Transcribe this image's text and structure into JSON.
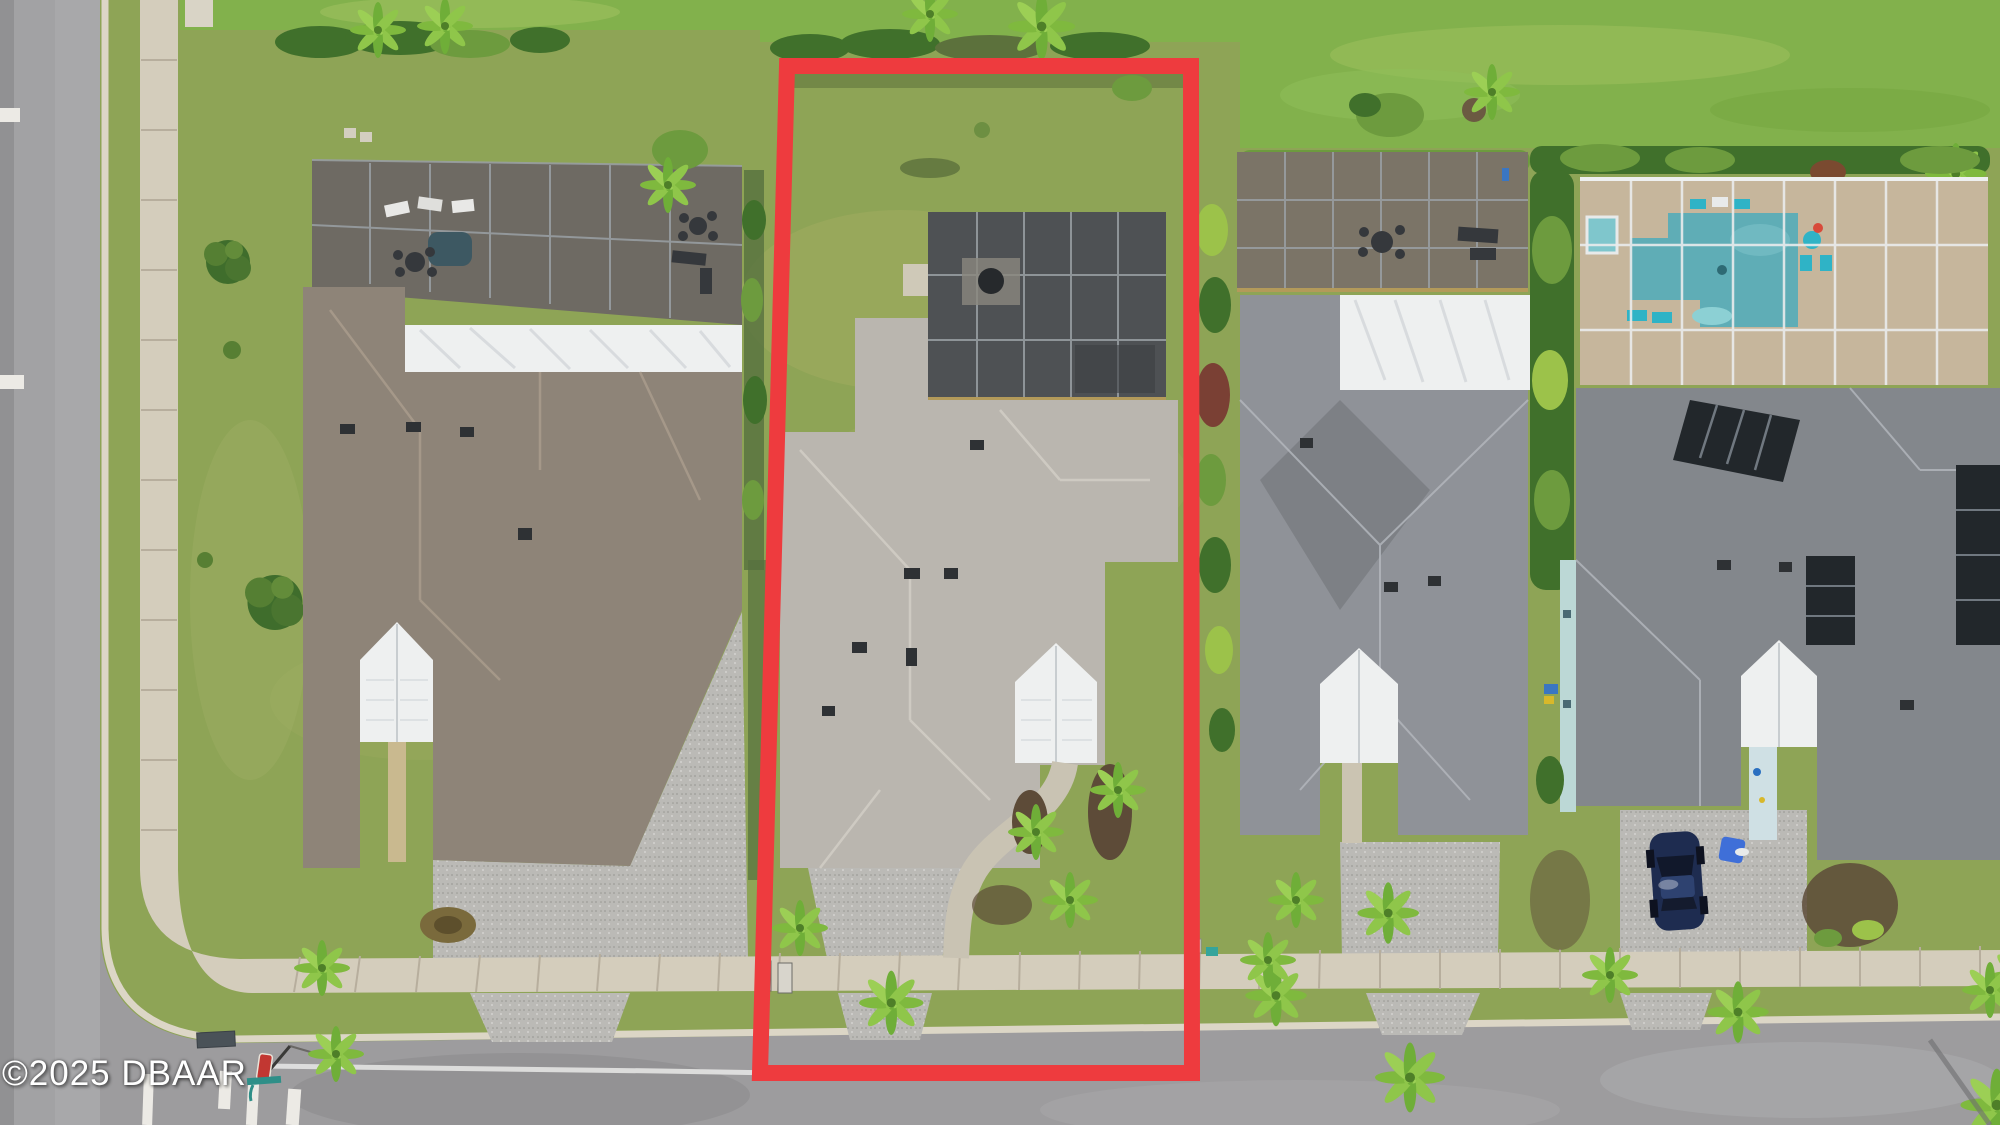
{
  "image": {
    "kind": "aerial-real-estate-photo",
    "width_px": 2000,
    "height_px": 1125,
    "watermark": {
      "text": "©2025 DBAAR",
      "color": "#ffffff"
    },
    "highlight_outline": {
      "meaning": "subject-property-lot-boundary",
      "color": "#ee3b3e",
      "shape": "tall-rectangle"
    }
  },
  "palette": {
    "road": "#a2a2a4",
    "sidewalk": "#d4cdbc",
    "curb": "#dcd6c6",
    "grass_olive": "#93a45e",
    "grass_bright": "#82b14c",
    "hedge": "#40702b",
    "palm": "#7fb93e",
    "roof_house_left": "#8e8478",
    "roof_subject": "#bab6af",
    "roof_house3": "#8f9298",
    "roof_house4": "#83878c",
    "white_gable": "#eef0f0",
    "pool_water": "#5fadb6",
    "screen_enclosure": "#4e5154",
    "driveway_pebble": "#bbbab6",
    "solar_panel": "#22272b",
    "car": "#1e2c50",
    "outline_red": "#ee3b3e"
  },
  "scene": {
    "setting": "single-family homes along a street corner, top-down drone view",
    "objects": [
      "vertical street with sidewalk on left",
      "horizontal street with sidewalk at bottom",
      "corner street sign and crosswalk stripes",
      "house-1 tan roof with screened pool enclosure and patio furniture",
      "subject lot outlined in red: gray roof home, rear screened lanai, white entry gable, paver driveway",
      "house-3 gray roof with large screened lanai and white roof band",
      "house-4 gray roof with screened pool (teal water), solar panels, navy car on driveway",
      "hedges and palms between lots, bright rear lawn"
    ]
  }
}
